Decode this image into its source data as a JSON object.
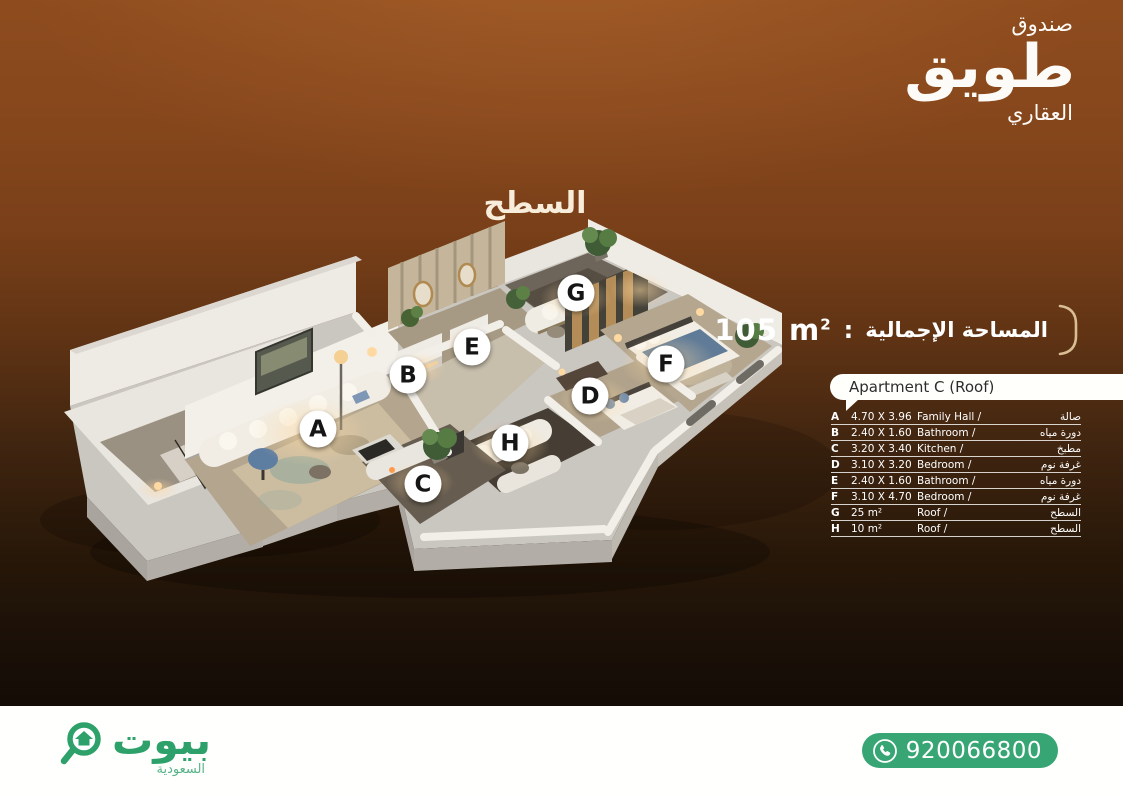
{
  "brand": {
    "top": "صندوق",
    "main": "طويق",
    "sub": "العقاري"
  },
  "title": "السطح",
  "area": {
    "value": "105 m",
    "sup": "2",
    "sep": ":",
    "label": "المساحة الإجمالية"
  },
  "panel": {
    "header": "Apartment C (Roof)",
    "rows": [
      {
        "letter": "A",
        "dim": "4.70 X 3.96",
        "en": "Family Hall /",
        "ar": "صالة"
      },
      {
        "letter": "B",
        "dim": "2.40 X 1.60",
        "en": "Bathroom /",
        "ar": "دورة مياه"
      },
      {
        "letter": "C",
        "dim": "3.20 X 3.40",
        "en": "Kitchen /",
        "ar": "مطبخ"
      },
      {
        "letter": "D",
        "dim": "3.10 X 3.20",
        "en": "Bedroom /",
        "ar": "غرفة نوم"
      },
      {
        "letter": "E",
        "dim": "2.40 X 1.60",
        "en": "Bathroom /",
        "ar": "دورة مياه"
      },
      {
        "letter": "F",
        "dim": "3.10 X 4.70",
        "en": "Bedroom /",
        "ar": "غرفة نوم"
      },
      {
        "letter": "G",
        "dim": "25 m²",
        "en": "Roof /",
        "ar": "السطح"
      },
      {
        "letter": "H",
        "dim": "10 m²",
        "en": "Roof /",
        "ar": "السطح"
      }
    ]
  },
  "markers": [
    {
      "letter": "A",
      "x": 318,
      "y": 429
    },
    {
      "letter": "B",
      "x": 408,
      "y": 375
    },
    {
      "letter": "C",
      "x": 423,
      "y": 484
    },
    {
      "letter": "D",
      "x": 590,
      "y": 396
    },
    {
      "letter": "E",
      "x": 472,
      "y": 347
    },
    {
      "letter": "F",
      "x": 666,
      "y": 364
    },
    {
      "letter": "G",
      "x": 576,
      "y": 293
    },
    {
      "letter": "H",
      "x": 510,
      "y": 443
    }
  ],
  "footer": {
    "logo_main": "بيوت",
    "logo_sub": "السعودية",
    "phone": "920066800"
  },
  "colors": {
    "brand_green": "#2ea16b",
    "pill_green": "#38a674",
    "bg_top": "#8e4c1e",
    "bg_bottom": "#140c06",
    "bracket_cream": "#d9bd93"
  }
}
